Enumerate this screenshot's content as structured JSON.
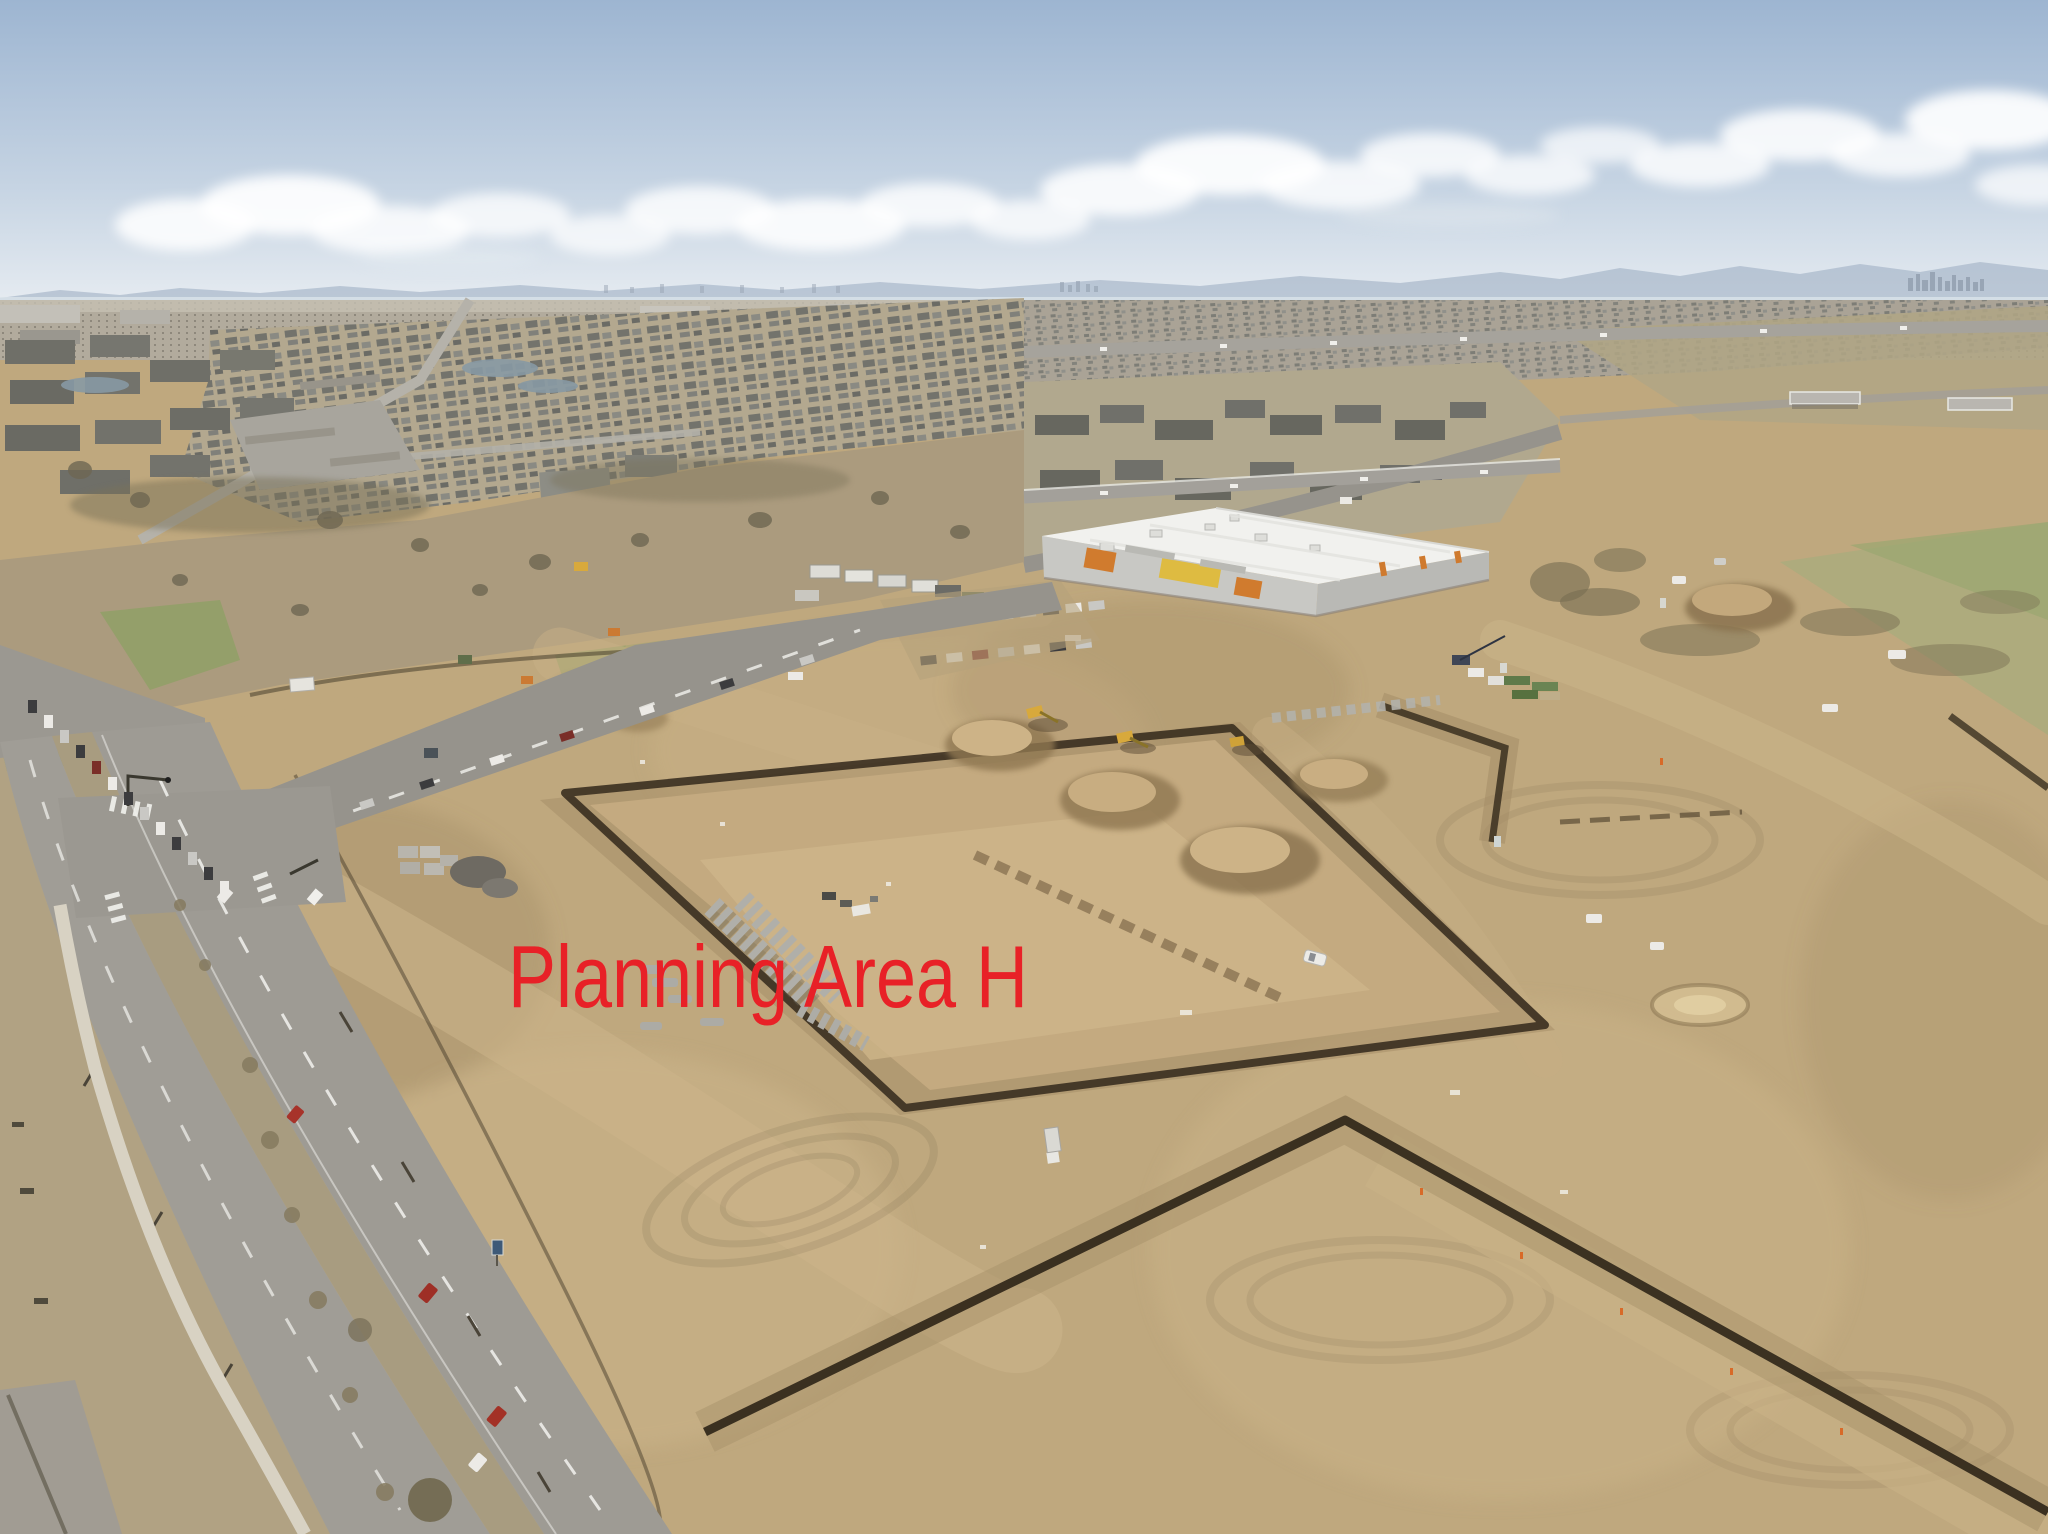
{
  "annotation": {
    "text": "Planning Area H",
    "color": "#e82127",
    "x": 508,
    "baseline_y": 1007,
    "font_px": 88,
    "width_px": 520
  },
  "scene": {
    "setting": "aerial-drone-photo-of-construction-site",
    "palette": {
      "sky_top": "#9db5d1",
      "sky_mid": "#c6d4e3",
      "sky_horizon": "#e8edf2",
      "cloud": "#ffffff",
      "mountain": "#9fafc3",
      "haze": "#dbe3ea",
      "dirt": "#bfa87e",
      "dirt_light": "#d0b88e",
      "dirt_dark": "#937d5b",
      "trench": "#33291c",
      "asphalt": "#9e9b94",
      "lane_marking": "#f5f5f2",
      "median_grass": "#a89c80",
      "dry_grass": "#b0a284",
      "green_grass": "#8ea065",
      "roof_white": "#f1f1ee",
      "wall_gray": "#c8c8c4",
      "wall_gray_dark": "#b9b9b5",
      "accent_orange": "#d07b2e",
      "accent_yellow": "#debb41",
      "suburb_roof": "#75756e",
      "apartment_roof": "#67675f",
      "pipe_gray": "#b0afa9",
      "vehicle_white": "#eceae6",
      "vehicle_red": "#a7332a",
      "machine_yellow": "#d8a93c"
    },
    "landmarks": [
      "sky-with-cumulus-clouds",
      "front-range-mountains",
      "downtown-skyline-on-horizon",
      "suburban-neighborhood",
      "apartment-complexes",
      "dry-field-with-bare-trees",
      "ponds",
      "distant-highway-with-overpasses",
      "divided-arterial-road",
      "signalized-intersection-with-crosswalks",
      "retail-building-under-construction",
      "construction-staging-area",
      "parked-cars",
      "excavators",
      "dirt-mounds",
      "utility-trenches",
      "graded-dirt-pad",
      "concrete-pipe-stacks",
      "concrete-block-stacks",
      "white-utility-truck",
      "white-suv-on-dirt",
      "multi-use-path",
      "median-trees",
      "blue-road-sign"
    ]
  }
}
